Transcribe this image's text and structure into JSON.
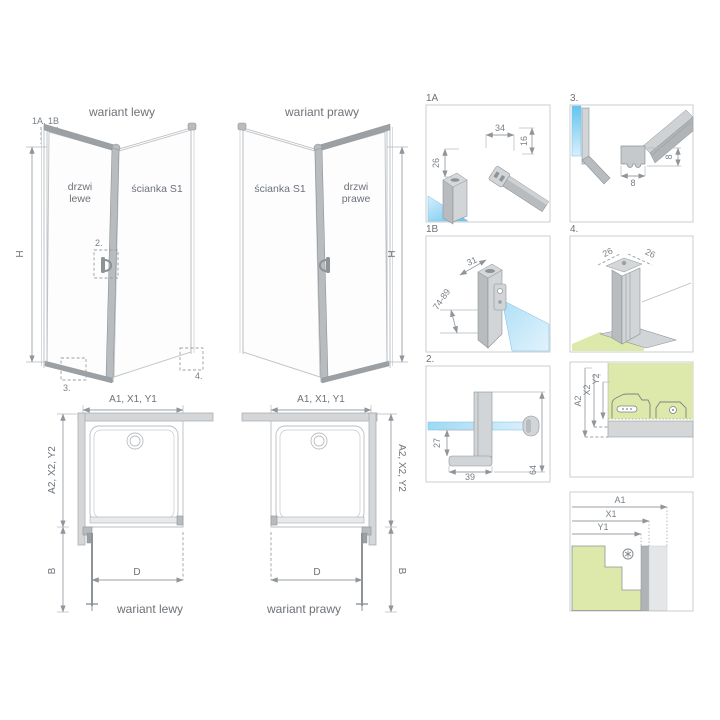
{
  "colors": {
    "glass_blue": "#8fd2f2",
    "floor_green": "#dde8ab",
    "profile_gray": "#b9bcbe",
    "line_gray": "#a7acb0",
    "text_gray": "#6d7278"
  },
  "left_view": {
    "title": "wariant lewy",
    "corner_markers": "1A, 1B",
    "door_label_line1": "drzwi",
    "door_label_line2": "lewe",
    "wall_label": "ścianka S1",
    "height_dim": "H",
    "handle_marker": "2.",
    "bottom_marker": "3.",
    "wall_marker": "4."
  },
  "right_view": {
    "title": "wariant prawy",
    "wall_label": "ścianka S1",
    "door_label_line1": "drzwi",
    "door_label_line2": "prawe",
    "height_dim": "H"
  },
  "left_plan": {
    "width_dim": "A1, X1, Y1",
    "depth_dim": "A2, X2, Y2",
    "door_dim": "D",
    "clearance_dim": "B",
    "caption": "wariant lewy"
  },
  "right_plan": {
    "width_dim": "A1, X1, Y1",
    "depth_dim": "A2, X2, Y2",
    "door_dim": "D",
    "clearance_dim": "B",
    "caption": "wariant prawy"
  },
  "details": {
    "d1a": {
      "label": "1A",
      "dim_width": "34",
      "dim_depth": "16",
      "dim_side": "26"
    },
    "d1b": {
      "label": "1B",
      "dim_width": "31",
      "dim_range": "74-89"
    },
    "d2": {
      "label": "2.",
      "dim_drop": "27",
      "dim_length": "39",
      "dim_height": "64"
    },
    "d3": {
      "label": "3.",
      "dim_width": "8",
      "dim_height": "8"
    },
    "d4": {
      "label": "4.",
      "dim_left": "26",
      "dim_right": "26"
    },
    "section_side": {
      "dim_a": "A2",
      "dim_x": "X2",
      "dim_y": "Y2"
    },
    "section_front": {
      "dim_a": "A1",
      "dim_x": "X1",
      "dim_y": "Y1"
    }
  }
}
